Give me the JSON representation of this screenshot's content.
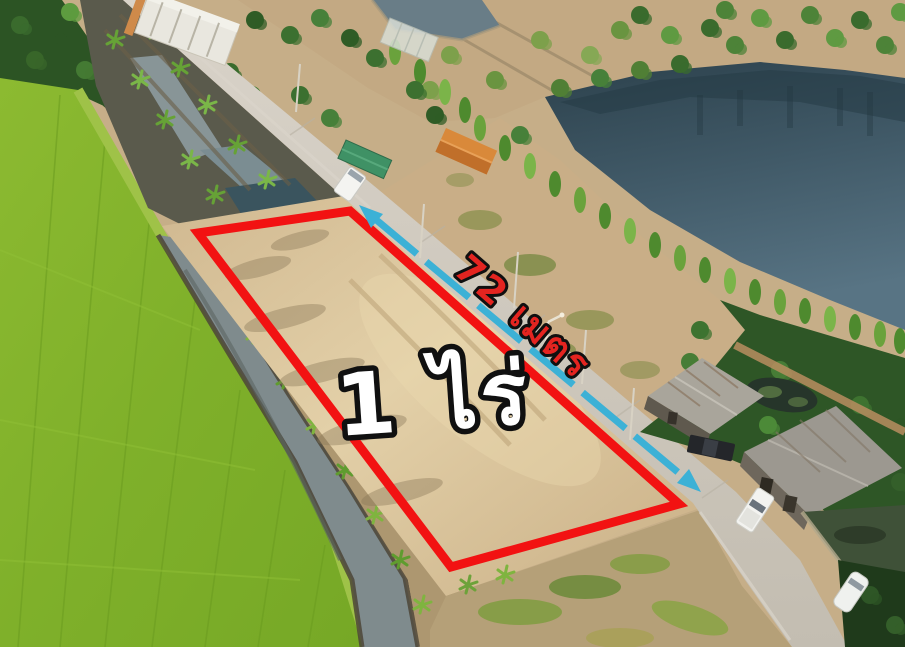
{
  "labels": {
    "area": "1 ไร่",
    "frontage": "72 เมตร"
  },
  "annotation_colors": {
    "plot_outline": "#f21212",
    "measure_line": "#3cb1d6",
    "area_text_fill": "#ffffff",
    "frontage_text_fill": "#e42420"
  }
}
